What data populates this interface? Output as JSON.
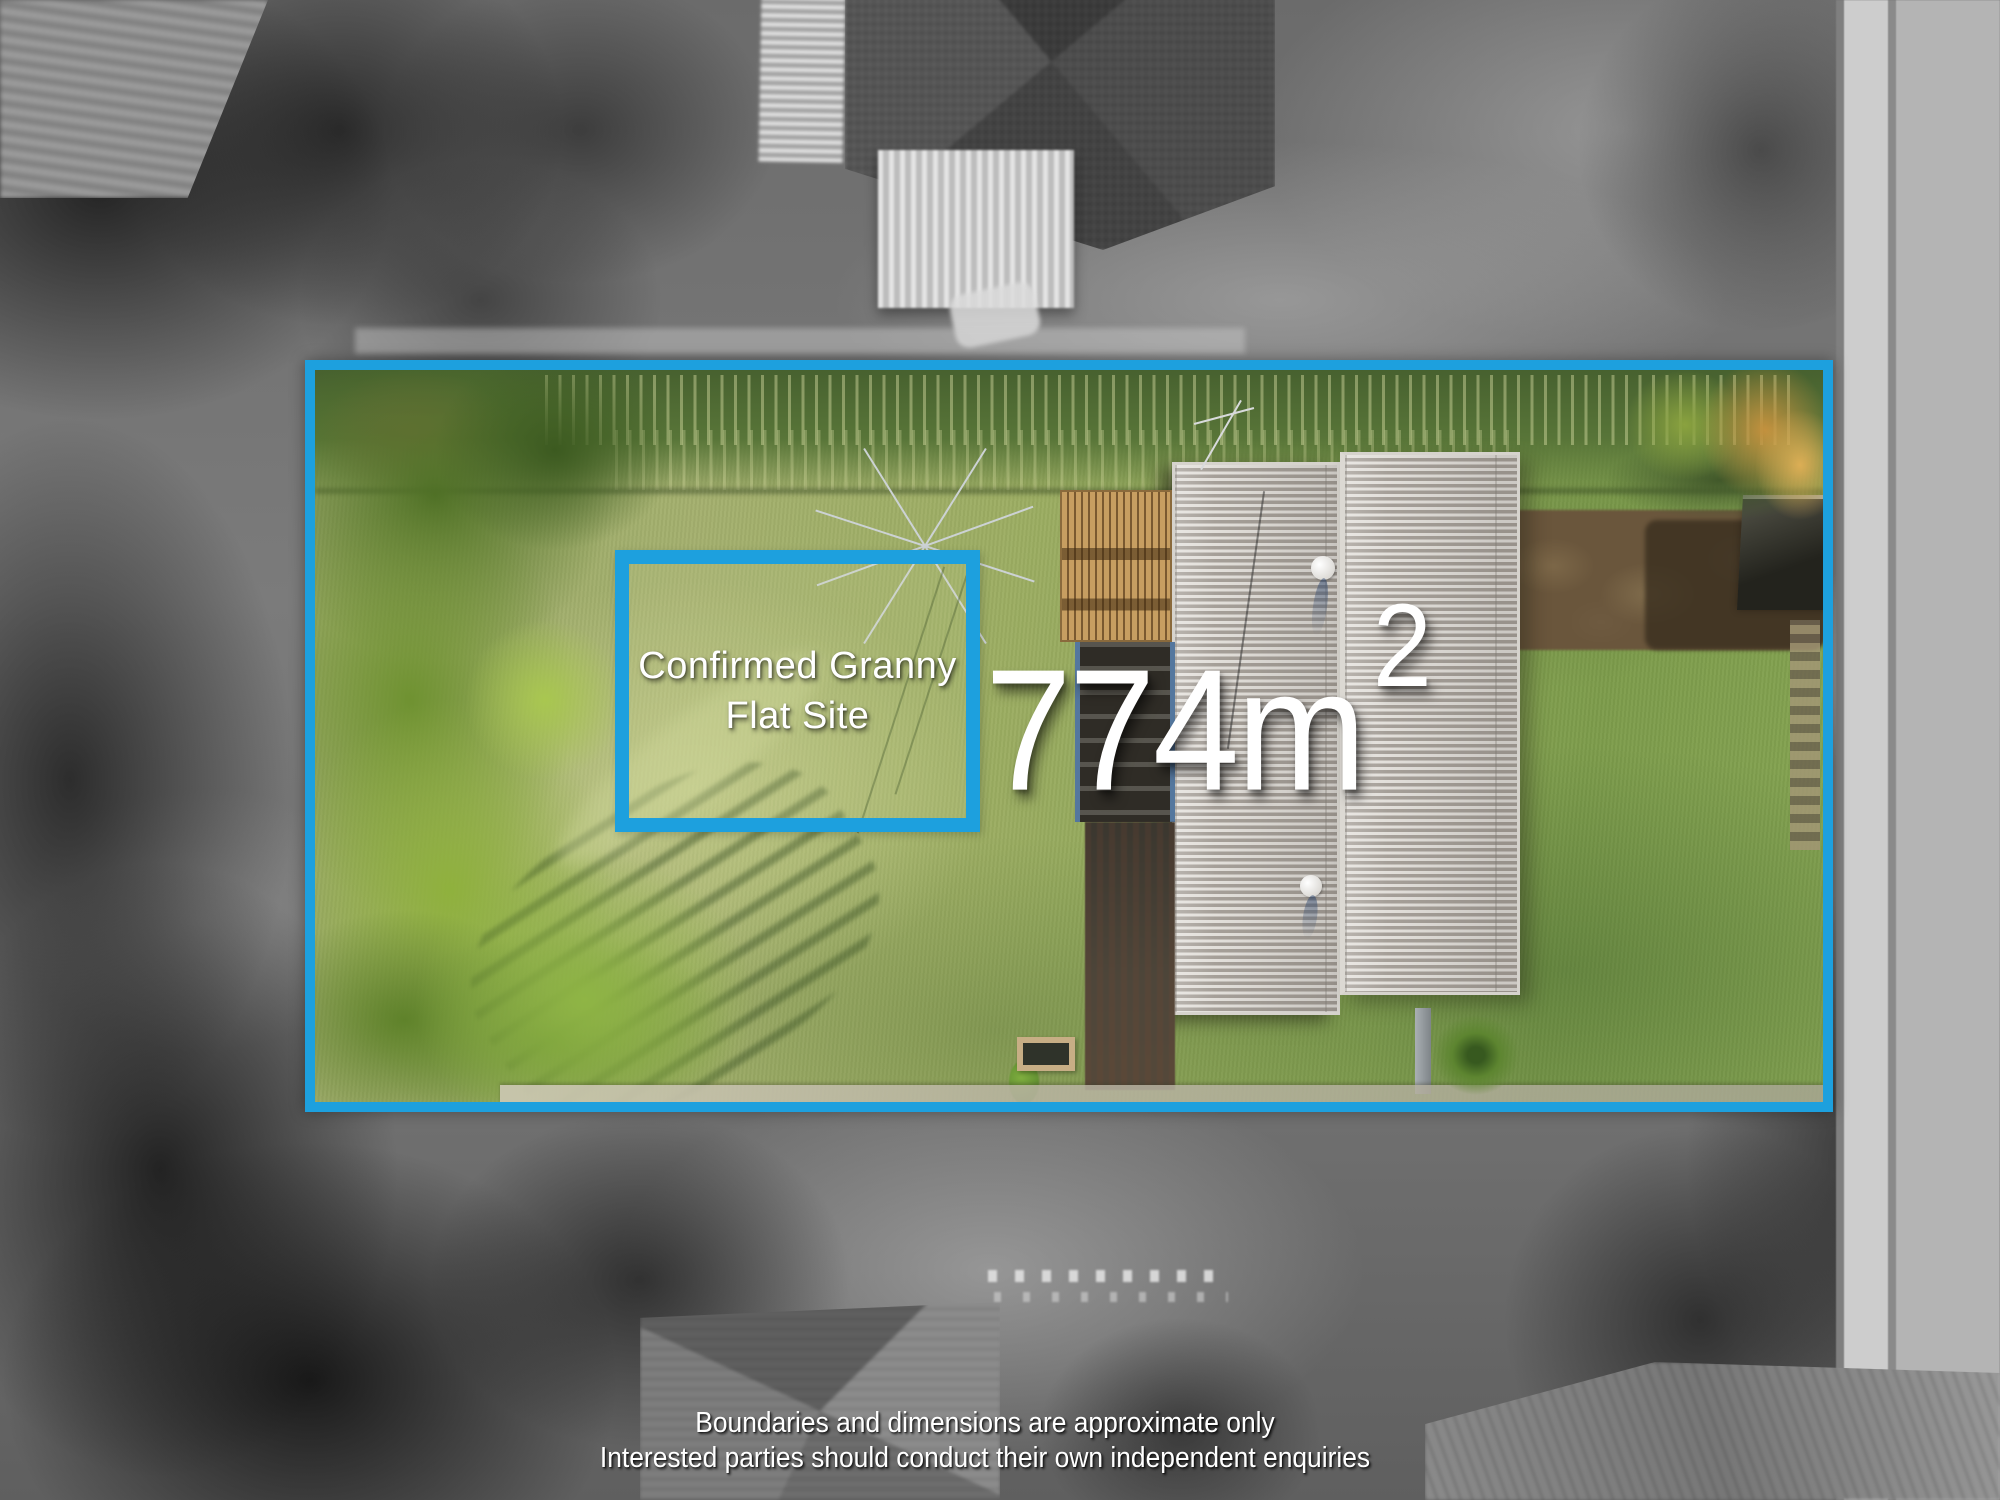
{
  "annotations": {
    "granny_flat_label": {
      "line1": "Confirmed Granny",
      "line2": "Flat Site"
    },
    "area_label": {
      "value": "774m",
      "superscript": "2"
    },
    "disclaimer": {
      "line1": "Boundaries and dimensions are approximate only",
      "line2": "Interested parties should conduct their own independent enquiries"
    }
  },
  "colors": {
    "boundary_blue": "#1da0de",
    "label_white": "#ffffff"
  }
}
